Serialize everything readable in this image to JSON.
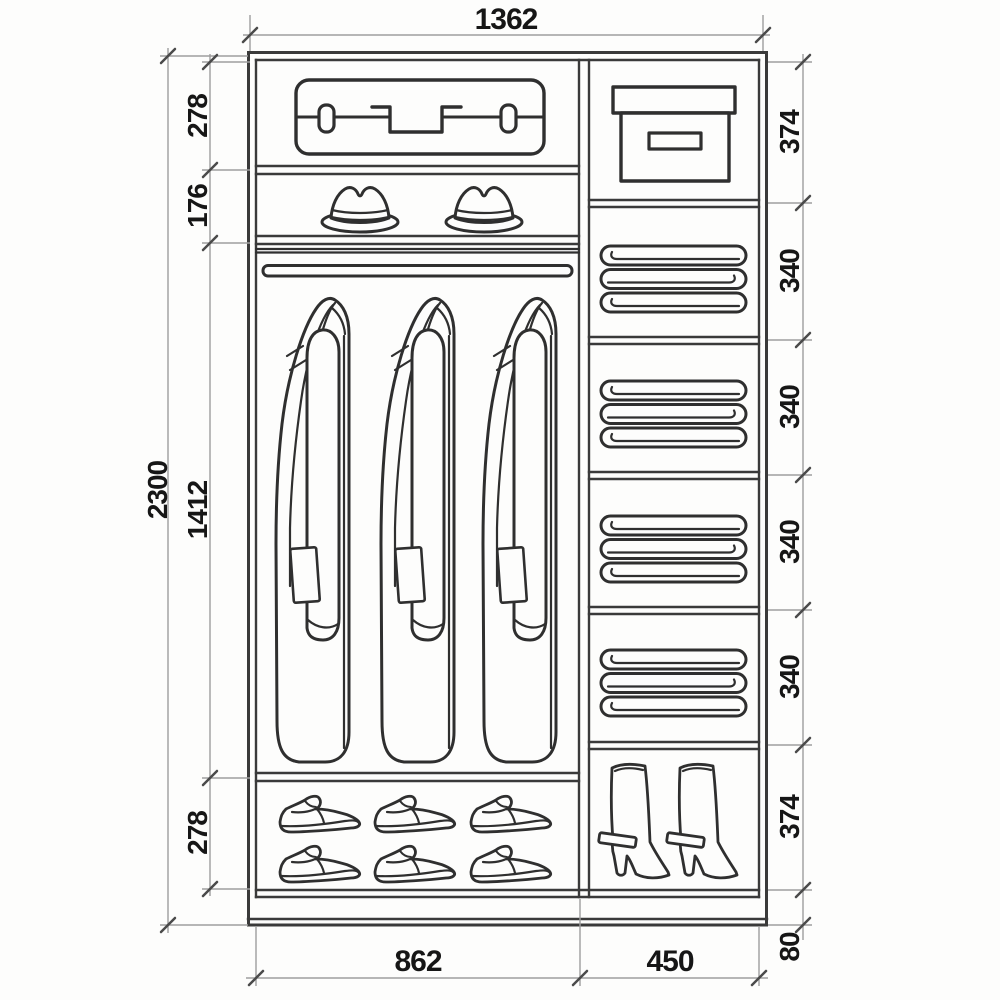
{
  "diagram": {
    "type": "wardrobe-interior-technical-drawing",
    "units": "mm",
    "dims": {
      "top_width": "1362",
      "total_height": "2300",
      "left": [
        "278",
        "176",
        "1412",
        "278"
      ],
      "right": [
        "374",
        "340",
        "340",
        "340",
        "340",
        "374"
      ],
      "base": "80",
      "bottom_left": "862",
      "bottom_right": "450"
    },
    "icons": [
      "suitcase-icon",
      "fedora-hat-icon",
      "coat-icon",
      "storage-box-icon",
      "folded-linen-icon",
      "dress-shoe-icon",
      "high-boot-icon"
    ],
    "colors": {
      "line": "#3a3a3a",
      "dimension_line": "#9e9e9e",
      "text": "#161616",
      "background": "#fdfdfc"
    }
  }
}
